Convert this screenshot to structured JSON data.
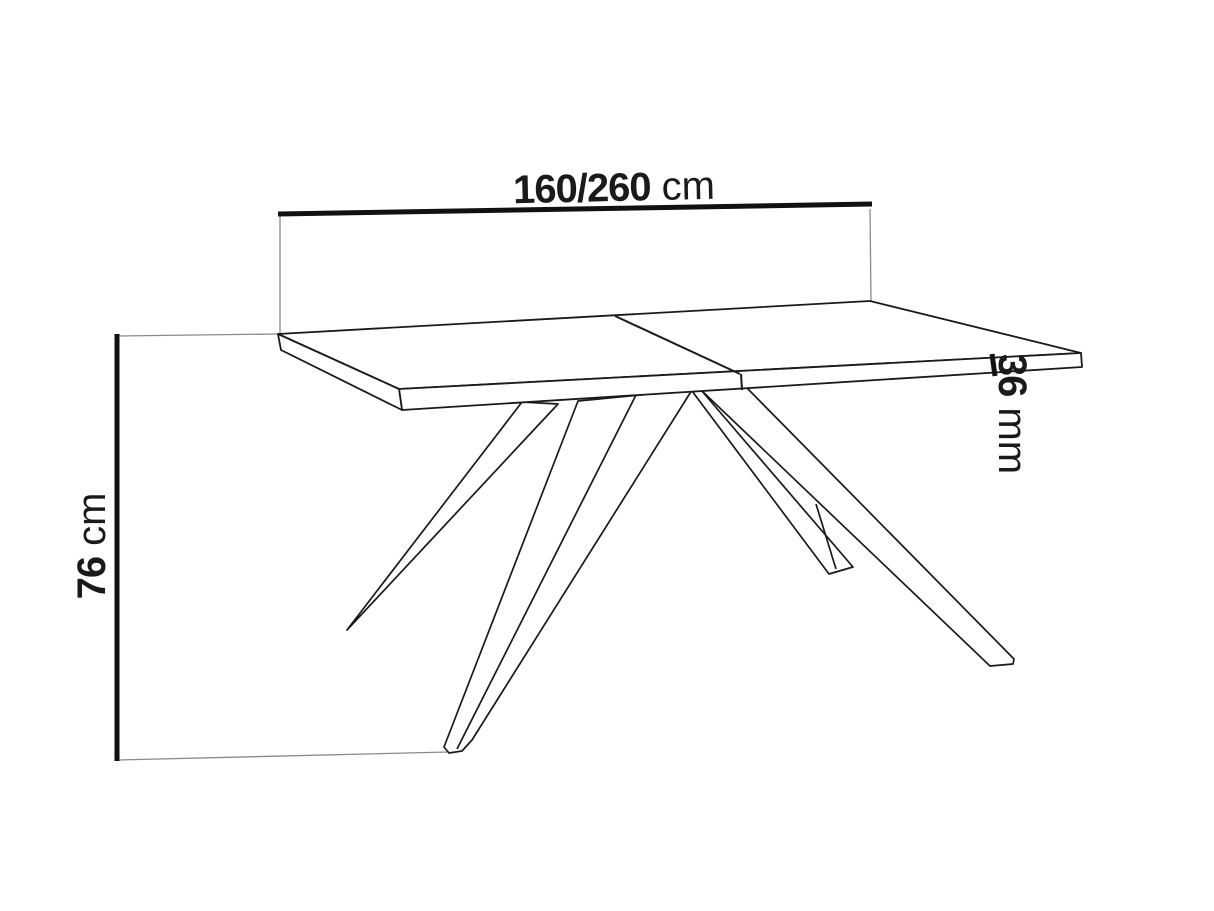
{
  "diagram": {
    "subject": "table-dimension-drawing",
    "dimensions": {
      "length": {
        "value": "160/260",
        "unit": "cm"
      },
      "height": {
        "value": "76",
        "unit": "cm"
      },
      "thickness": {
        "value": "36",
        "unit": "mm"
      }
    },
    "colors": {
      "background": "#ffffff",
      "outline": "#1a1a1a",
      "dimension_line": "#111111",
      "extension_line": "#8a8a8a",
      "text": "#1a1a1a"
    }
  }
}
